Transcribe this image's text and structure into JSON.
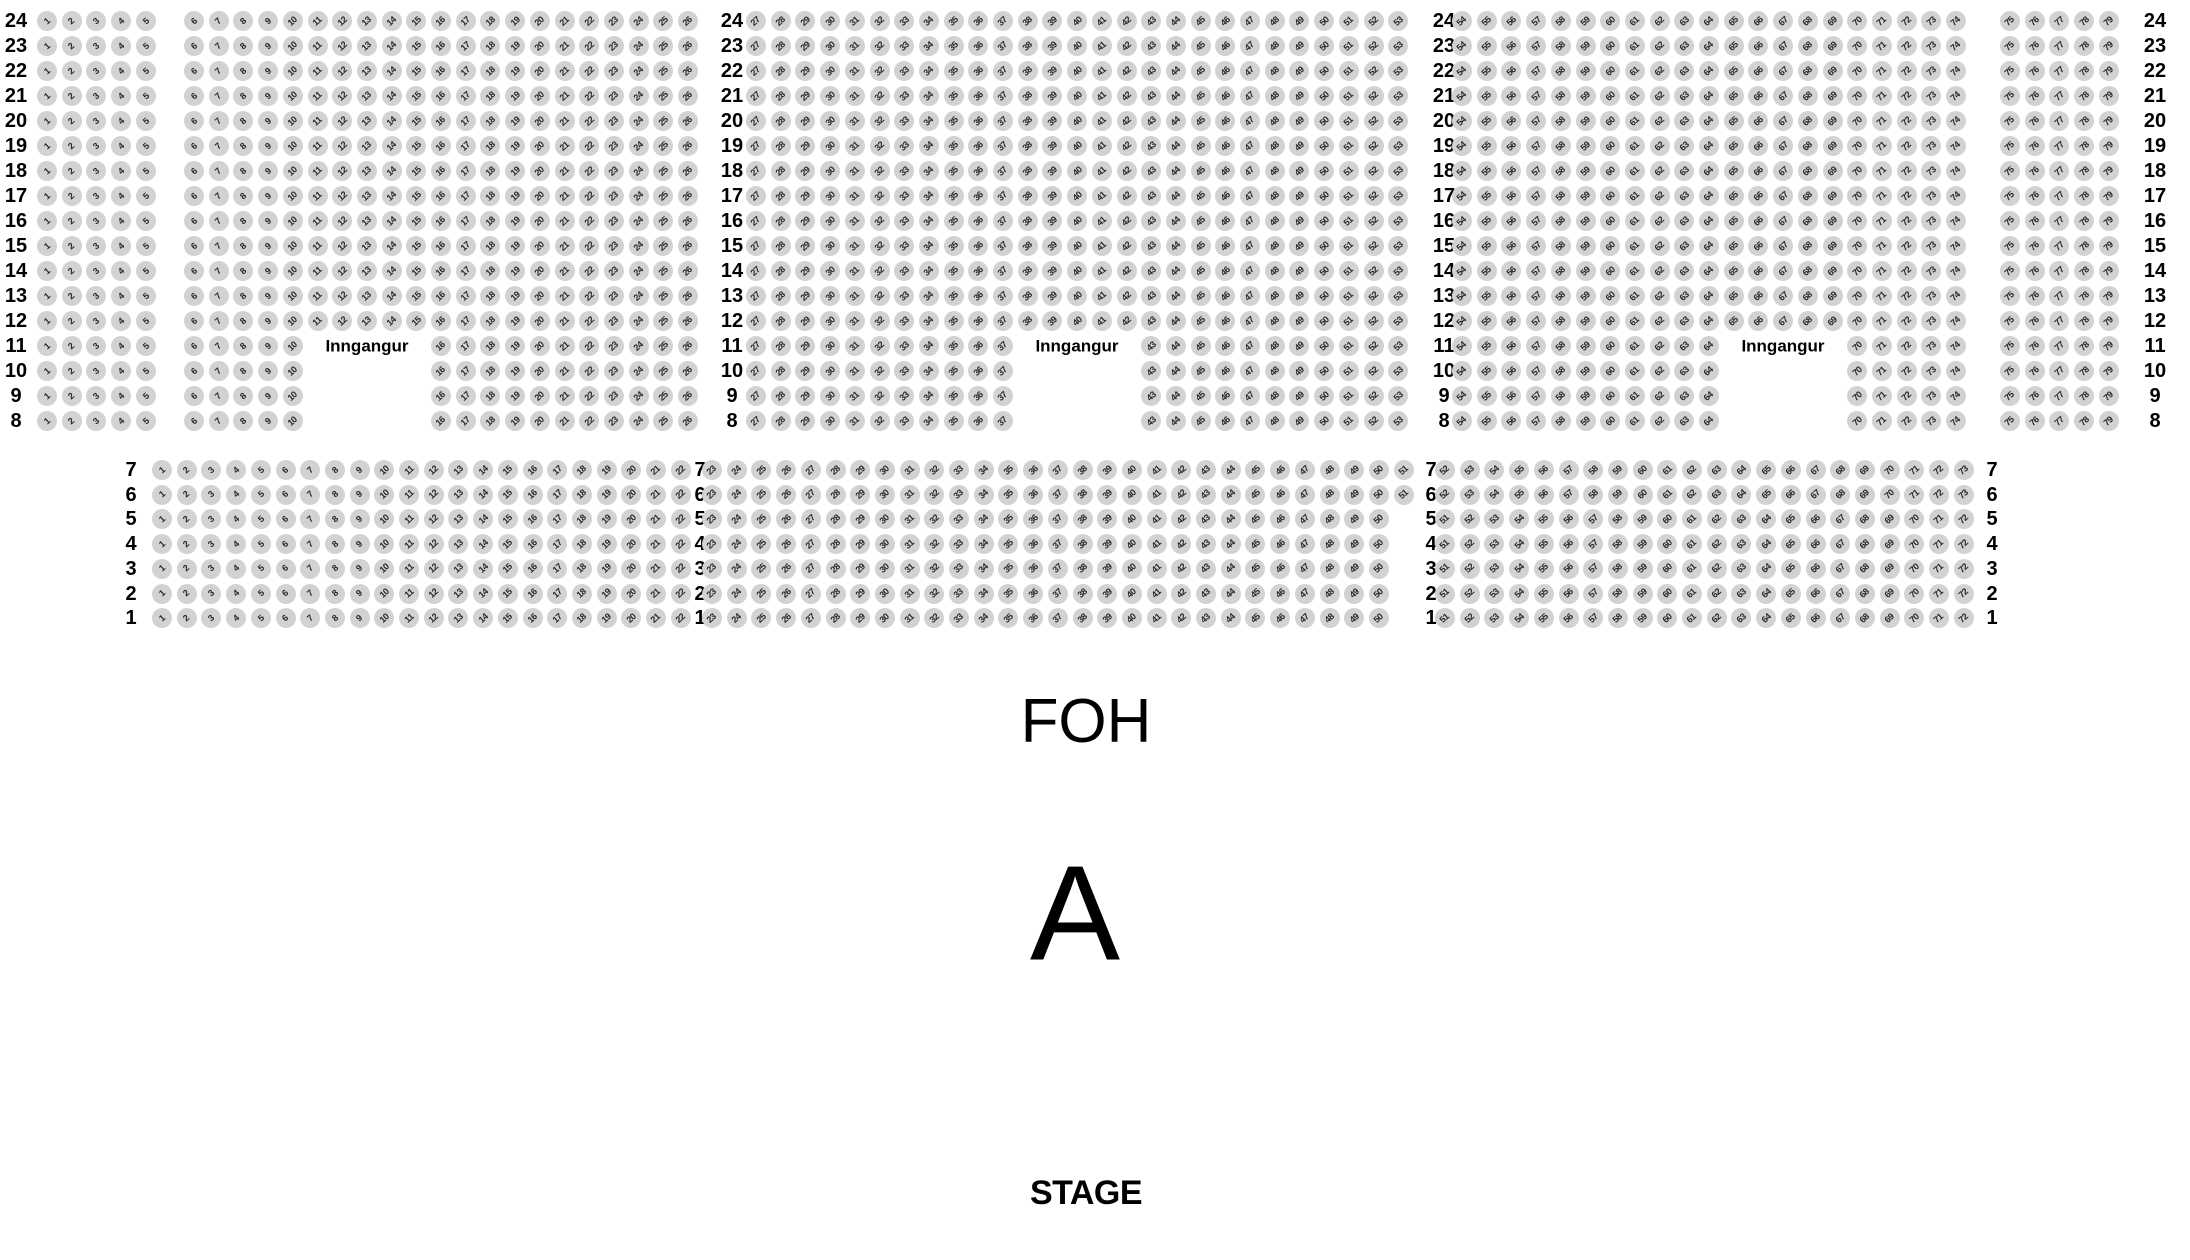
{
  "labels": {
    "entrance": "Inngangur",
    "foh": "FOH",
    "section": "A",
    "stage": "STAGE"
  },
  "colors": {
    "background": "#ffffff",
    "seat_fill": "#d2d2d2",
    "seat_number": "#262626",
    "text": "#000000"
  },
  "seatmap": {
    "seat_diameter": 20,
    "seat_pitch": 24.7,
    "upper": {
      "rows_from": 24,
      "rows_to": 8,
      "first_row_y": 21,
      "row_pitch": 25,
      "row_label_columns_x": [
        16,
        732,
        1444,
        2155
      ],
      "blocks": [
        {
          "from": 1,
          "to": 5,
          "x": 47
        },
        {
          "from": 6,
          "to": 26,
          "x": 194
        },
        {
          "from": 27,
          "to": 53,
          "x": 756
        },
        {
          "from": 54,
          "to": 74,
          "x": 1462
        },
        {
          "from": 75,
          "to": 79,
          "x": 2010
        }
      ],
      "entrances": [
        {
          "rows_from": 8,
          "rows_to": 11,
          "seats_from": 11,
          "seats_to": 15,
          "label_row": 11,
          "label_x": 367
        },
        {
          "rows_from": 8,
          "rows_to": 11,
          "seats_from": 38,
          "seats_to": 42,
          "label_row": 11,
          "label_x": 1077
        },
        {
          "rows_from": 8,
          "rows_to": 11,
          "seats_from": 65,
          "seats_to": 69,
          "label_row": 11,
          "label_x": 1783
        }
      ]
    },
    "lower": {
      "rows_from": 7,
      "rows_to": 1,
      "first_row_y": 470,
      "row_pitch": 24.7,
      "row_label_columns_x": [
        131,
        700,
        1431,
        1992
      ],
      "row_groups": [
        {
          "rows": [
            7,
            6
          ],
          "segments": [
            {
              "from": 1,
              "to": 22,
              "x": 162
            },
            {
              "from": 23,
              "to": 51,
              "x": 712
            },
            {
              "from": 52,
              "to": 73,
              "x": 1445
            }
          ]
        },
        {
          "rows": [
            5,
            4,
            3,
            2,
            1
          ],
          "segments": [
            {
              "from": 1,
              "to": 22,
              "x": 162
            },
            {
              "from": 23,
              "to": 50,
              "x": 712
            },
            {
              "from": 51,
              "to": 72,
              "x": 1445
            }
          ]
        }
      ]
    }
  }
}
